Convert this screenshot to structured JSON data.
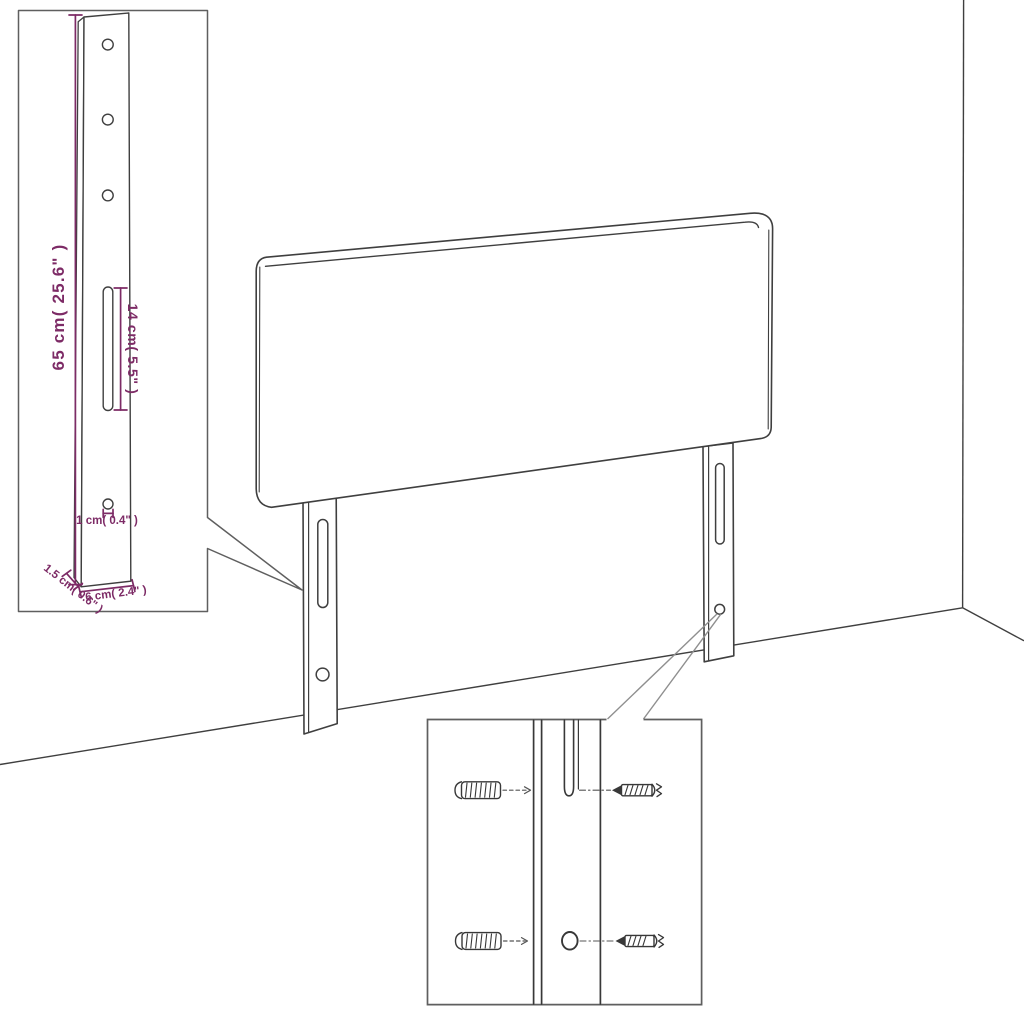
{
  "diagram": {
    "kind": "furniture-assembly-dimension-diagram",
    "subject": "upholstered headboard with two mounting legs, wall corner and hardware close-up",
    "colors": {
      "background": "#ffffff",
      "dimension_accent": "#7d2b66",
      "drawing_line": "#3f3f3f",
      "inset_border": "#5f5f5f",
      "callout_line": "#8f8f8f",
      "hardware_line": "#383838",
      "guide_line": "#555555"
    },
    "bracket_inset": {
      "labels": {
        "height": "65 cm( 25.6\" )",
        "slot_length": "14 cm( 5.5\" )",
        "hole_diameter": "1 cm( 0.4\" )",
        "depth": "1.5 cm( 0.6\" )",
        "width": "6 cm( 2.4\" )"
      }
    },
    "mounting_inset": {
      "hardware": [
        "wall plug",
        "screw into slot",
        "wall plug",
        "screw into hole"
      ]
    }
  }
}
